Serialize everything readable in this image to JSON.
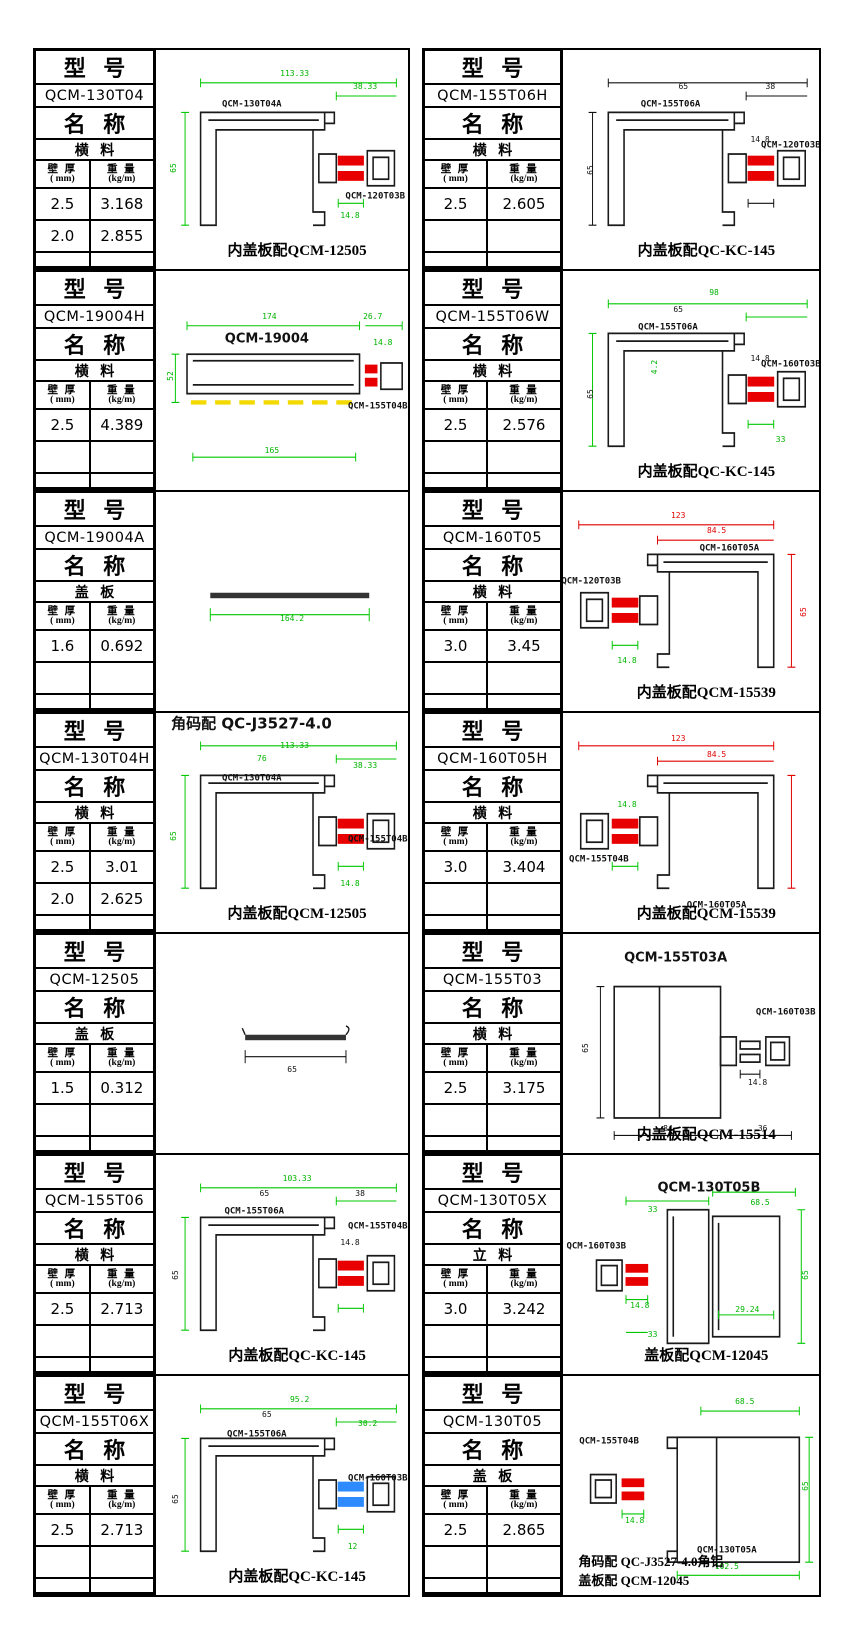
{
  "labels": {
    "model": "型  号",
    "name": "名  称",
    "wall": "壁 厚",
    "wall_unit": "( mm)",
    "weight": "重 量",
    "weight_unit": "(kg/m)"
  },
  "colors": {
    "dim_green": "#00c800",
    "dim_red": "#e00000",
    "connector_red": "#e80000",
    "connector_blue": "#2e8bff",
    "dashed_yellow": "#f2d900"
  },
  "blocks": [
    {
      "col": 0,
      "model": "QCM-130T04",
      "name": "横  料",
      "rows": [
        [
          "2.5",
          "3.168"
        ],
        [
          "2.0",
          "2.855"
        ],
        [
          "",
          ""
        ]
      ],
      "drawing": {
        "variant": "channelRight",
        "conn": "#e80000",
        "dimc": "#00c800",
        "annotations": [
          {
            "t": "113.33",
            "k": "dim",
            "c": "green",
            "x": 55,
            "y": 11
          },
          {
            "t": "38.33",
            "k": "dim",
            "c": "green",
            "x": 83,
            "y": 17
          },
          {
            "t": "QCM-130T04A",
            "k": "label",
            "c": "black",
            "x": 38,
            "y": 25
          },
          {
            "t": "65",
            "k": "dim",
            "c": "green",
            "x": 7,
            "y": 54,
            "rot": true
          },
          {
            "t": "14.8",
            "k": "dim",
            "c": "green",
            "x": 77,
            "y": 76
          },
          {
            "t": "QCM-120T03B",
            "k": "label",
            "c": "black",
            "x": 87,
            "y": 67
          }
        ],
        "caption": "内盖板配QCM-12505",
        "caption2": ""
      }
    },
    {
      "col": 0,
      "model": "QCM-19004H",
      "name": "横  料",
      "rows": [
        [
          "2.5",
          "4.389"
        ],
        [
          "",
          ""
        ],
        [
          "",
          ""
        ]
      ],
      "drawing": {
        "variant": "longbox",
        "conn": "#e80000",
        "dimc": "#00c800",
        "annotations": [
          {
            "t": "174",
            "k": "dim",
            "c": "green",
            "x": 45,
            "y": 21
          },
          {
            "t": "26.7",
            "k": "dim",
            "c": "green",
            "x": 86,
            "y": 21
          },
          {
            "t": "QCM-19004",
            "k": "title",
            "c": "black",
            "x": 44,
            "y": 31
          },
          {
            "t": "52",
            "k": "dim",
            "c": "green",
            "x": 6,
            "y": 48,
            "rot": true
          },
          {
            "t": "14.8",
            "k": "dim",
            "c": "green",
            "x": 90,
            "y": 33
          },
          {
            "t": "QCM-155T04B",
            "k": "label",
            "c": "black",
            "x": 88,
            "y": 62
          },
          {
            "t": "165",
            "k": "dim",
            "c": "green",
            "x": 46,
            "y": 82
          }
        ],
        "caption": "",
        "caption2": ""
      }
    },
    {
      "col": 0,
      "model": "QCM-19004A",
      "name": "盖  板",
      "rows": [
        [
          "1.6",
          "0.692"
        ],
        [
          "",
          ""
        ],
        [
          "",
          ""
        ]
      ],
      "drawing": {
        "variant": "flatbar",
        "conn": "#e80000",
        "dimc": "#00c800",
        "annotations": [
          {
            "t": "164.2",
            "k": "dim",
            "c": "green",
            "x": 54,
            "y": 58
          }
        ],
        "caption": "",
        "caption2": ""
      }
    },
    {
      "col": 0,
      "model": "QCM-130T04H",
      "name": "横  料",
      "rows": [
        [
          "2.5",
          "3.01"
        ],
        [
          "2.0",
          "2.625"
        ],
        [
          "",
          ""
        ]
      ],
      "drawing": {
        "variant": "channelRight",
        "conn": "#e80000",
        "dimc": "#00c800",
        "annotations": [
          {
            "t": "角码配 QC-J3527-4.0",
            "k": "note",
            "c": "black",
            "x": 6,
            "y": 5
          },
          {
            "t": "113.33",
            "k": "dim",
            "c": "green",
            "x": 55,
            "y": 15
          },
          {
            "t": "76",
            "k": "dim",
            "c": "green",
            "x": 42,
            "y": 21
          },
          {
            "t": "38.33",
            "k": "dim",
            "c": "green",
            "x": 83,
            "y": 24
          },
          {
            "t": "QCM-130T04A",
            "k": "label",
            "c": "black",
            "x": 38,
            "y": 30
          },
          {
            "t": "65",
            "k": "dim",
            "c": "green",
            "x": 7,
            "y": 56,
            "rot": true
          },
          {
            "t": "14.8",
            "k": "dim",
            "c": "green",
            "x": 77,
            "y": 78
          },
          {
            "t": "QCM-155T04B",
            "k": "label",
            "c": "black",
            "x": 88,
            "y": 58
          }
        ],
        "caption": "内盖板配QCM-12505",
        "caption2": ""
      }
    },
    {
      "col": 0,
      "model": "QCM-12505",
      "name": "盖  板",
      "rows": [
        [
          "1.5",
          "0.312"
        ],
        [
          "",
          ""
        ],
        [
          "",
          ""
        ]
      ],
      "drawing": {
        "variant": "flatbarShort",
        "conn": "#e80000",
        "dimc": "#111111",
        "annotations": [
          {
            "t": "65",
            "k": "dim",
            "c": "black",
            "x": 54,
            "y": 62
          }
        ],
        "caption": "",
        "caption2": ""
      }
    },
    {
      "col": 0,
      "model": "QCM-155T06",
      "name": "横  料",
      "rows": [
        [
          "2.5",
          "2.713"
        ],
        [
          "",
          ""
        ],
        [
          "",
          ""
        ]
      ],
      "drawing": {
        "variant": "channelRight",
        "conn": "#e80000",
        "dimc": "#00c800",
        "annotations": [
          {
            "t": "103.33",
            "k": "dim",
            "c": "green",
            "x": 56,
            "y": 11
          },
          {
            "t": "65",
            "k": "dim",
            "c": "black",
            "x": 43,
            "y": 18
          },
          {
            "t": "38",
            "k": "dim",
            "c": "black",
            "x": 81,
            "y": 18
          },
          {
            "t": "QCM-155T06A",
            "k": "label",
            "c": "black",
            "x": 39,
            "y": 26
          },
          {
            "t": "65",
            "k": "dim",
            "c": "black",
            "x": 8,
            "y": 55,
            "rot": true
          },
          {
            "t": "14.8",
            "k": "dim",
            "c": "black",
            "x": 77,
            "y": 40
          },
          {
            "t": "QCM-155T04B",
            "k": "label",
            "c": "black",
            "x": 88,
            "y": 33
          }
        ],
        "caption": "内盖板配QC-KC-145",
        "caption2": ""
      }
    },
    {
      "col": 0,
      "model": "QCM-155T06X",
      "name": "横  料",
      "rows": [
        [
          "2.5",
          "2.713"
        ],
        [
          "",
          ""
        ],
        [
          "",
          ""
        ]
      ],
      "drawing": {
        "variant": "channelRight",
        "conn": "#2e8bff",
        "dimc": "#00c800",
        "annotations": [
          {
            "t": "95.2",
            "k": "dim",
            "c": "green",
            "x": 57,
            "y": 11
          },
          {
            "t": "65",
            "k": "dim",
            "c": "black",
            "x": 44,
            "y": 18
          },
          {
            "t": "30.2",
            "k": "dim",
            "c": "green",
            "x": 84,
            "y": 22
          },
          {
            "t": "QCM-155T06A",
            "k": "label",
            "c": "black",
            "x": 40,
            "y": 27
          },
          {
            "t": "65",
            "k": "dim",
            "c": "black",
            "x": 8,
            "y": 56,
            "rot": true
          },
          {
            "t": "QCM-160T03B",
            "k": "label",
            "c": "black",
            "x": 88,
            "y": 47
          },
          {
            "t": "12",
            "k": "dim",
            "c": "green",
            "x": 78,
            "y": 78
          }
        ],
        "caption": "内盖板配QC-KC-145",
        "caption2": ""
      }
    },
    {
      "col": 1,
      "model": "QCM-155T06H",
      "name": "横  料",
      "rows": [
        [
          "2.5",
          "2.605"
        ],
        [
          "",
          ""
        ],
        [
          "",
          ""
        ]
      ],
      "drawing": {
        "variant": "channelRight",
        "conn": "#e80000",
        "dimc": "#111111",
        "annotations": [
          {
            "t": "65",
            "k": "dim",
            "c": "black",
            "x": 47,
            "y": 17
          },
          {
            "t": "38",
            "k": "dim",
            "c": "black",
            "x": 81,
            "y": 17
          },
          {
            "t": "QCM-155T06A",
            "k": "label",
            "c": "black",
            "x": 42,
            "y": 25
          },
          {
            "t": "65",
            "k": "dim",
            "c": "black",
            "x": 11,
            "y": 55,
            "rot": true
          },
          {
            "t": "14.8",
            "k": "dim",
            "c": "black",
            "x": 77,
            "y": 41
          },
          {
            "t": "QCM-120T03B",
            "k": "label",
            "c": "black",
            "x": 89,
            "y": 44
          }
        ],
        "caption": "内盖板配QC-KC-145",
        "caption2": ""
      }
    },
    {
      "col": 1,
      "model": "QCM-155T06W",
      "name": "横  料",
      "rows": [
        [
          "2.5",
          "2.576"
        ],
        [
          "",
          ""
        ],
        [
          "",
          ""
        ]
      ],
      "drawing": {
        "variant": "channelRight",
        "conn": "#e80000",
        "dimc": "#00c800",
        "annotations": [
          {
            "t": "98",
            "k": "dim",
            "c": "green",
            "x": 59,
            "y": 10
          },
          {
            "t": "65",
            "k": "dim",
            "c": "black",
            "x": 45,
            "y": 18
          },
          {
            "t": "QCM-155T06A",
            "k": "label",
            "c": "black",
            "x": 41,
            "y": 26
          },
          {
            "t": "4.2",
            "k": "dim",
            "c": "green",
            "x": 36,
            "y": 44,
            "rot": true
          },
          {
            "t": "65",
            "k": "dim",
            "c": "black",
            "x": 11,
            "y": 56,
            "rot": true
          },
          {
            "t": "14.8",
            "k": "dim",
            "c": "black",
            "x": 77,
            "y": 40
          },
          {
            "t": "QCM-160T03B",
            "k": "label",
            "c": "black",
            "x": 89,
            "y": 43
          },
          {
            "t": "33",
            "k": "dim",
            "c": "green",
            "x": 85,
            "y": 77
          }
        ],
        "caption": "内盖板配QC-KC-145",
        "caption2": ""
      }
    },
    {
      "col": 1,
      "model": "QCM-160T05",
      "name": "横  料",
      "rows": [
        [
          "3.0",
          "3.45"
        ],
        [
          "",
          ""
        ],
        [
          "",
          ""
        ]
      ],
      "drawing": {
        "variant": "channelLeft",
        "conn": "#e80000",
        "dimc": "#e00000",
        "annotations": [
          {
            "t": "123",
            "k": "dim",
            "c": "red",
            "x": 45,
            "y": 11
          },
          {
            "t": "84.5",
            "k": "dim",
            "c": "red",
            "x": 60,
            "y": 18
          },
          {
            "t": "QCM-160T05A",
            "k": "label",
            "c": "black",
            "x": 65,
            "y": 26
          },
          {
            "t": "QCM-120T03B",
            "k": "label",
            "c": "black",
            "x": 11,
            "y": 41
          },
          {
            "t": "65",
            "k": "dim",
            "c": "red",
            "x": 94,
            "y": 55,
            "rot": true
          },
          {
            "t": "14.8",
            "k": "dim",
            "c": "green",
            "x": 25,
            "y": 77
          }
        ],
        "caption": "内盖板配QCM-15539",
        "caption2": ""
      }
    },
    {
      "col": 1,
      "model": "QCM-160T05H",
      "name": "横  料",
      "rows": [
        [
          "3.0",
          "3.404"
        ],
        [
          "",
          ""
        ],
        [
          "",
          ""
        ]
      ],
      "drawing": {
        "variant": "channelLeft",
        "conn": "#e80000",
        "dimc": "#e00000",
        "annotations": [
          {
            "t": "123",
            "k": "dim",
            "c": "red",
            "x": 45,
            "y": 12
          },
          {
            "t": "84.5",
            "k": "dim",
            "c": "red",
            "x": 60,
            "y": 19
          },
          {
            "t": "14.8",
            "k": "dim",
            "c": "green",
            "x": 25,
            "y": 42
          },
          {
            "t": "QCM-155T04B",
            "k": "label",
            "c": "black",
            "x": 14,
            "y": 67
          },
          {
            "t": "QCM-160T05A",
            "k": "label",
            "c": "black",
            "x": 60,
            "y": 88
          }
        ],
        "caption": "内盖板配QCM-15539",
        "caption2": ""
      }
    },
    {
      "col": 1,
      "model": "QCM-155T03",
      "name": "横  料",
      "rows": [
        [
          "2.5",
          "3.175"
        ],
        [
          "",
          ""
        ],
        [
          "",
          ""
        ]
      ],
      "drawing": {
        "variant": "tallbox",
        "conn": "#111111",
        "dimc": "#111111",
        "annotations": [
          {
            "t": "QCM-155T03A",
            "k": "title",
            "c": "black",
            "x": 44,
            "y": 11
          },
          {
            "t": "65",
            "k": "dim",
            "c": "black",
            "x": 9,
            "y": 52,
            "rot": true
          },
          {
            "t": "QCM-160T03B",
            "k": "label",
            "c": "black",
            "x": 87,
            "y": 36
          },
          {
            "t": "14.8",
            "k": "dim",
            "c": "black",
            "x": 76,
            "y": 68
          },
          {
            "t": "84",
            "k": "dim",
            "c": "black",
            "x": 41,
            "y": 89
          },
          {
            "t": "36",
            "k": "dim",
            "c": "black",
            "x": 78,
            "y": 89
          }
        ],
        "caption": "内盖板配QCM-15514",
        "caption2": ""
      }
    },
    {
      "col": 1,
      "model": "QCM-130T05X",
      "name": "立  料",
      "rows": [
        [
          "3.0",
          "3.242"
        ],
        [
          "",
          ""
        ],
        [
          "",
          ""
        ]
      ],
      "drawing": {
        "variant": "mullion",
        "conn": "#e80000",
        "dimc": "#00c800",
        "annotations": [
          {
            "t": "QCM-130T05B",
            "k": "title",
            "c": "black",
            "x": 57,
            "y": 15
          },
          {
            "t": "33",
            "k": "dim",
            "c": "green",
            "x": 35,
            "y": 25
          },
          {
            "t": "68.5",
            "k": "dim",
            "c": "green",
            "x": 77,
            "y": 22
          },
          {
            "t": "QCM-160T03B",
            "k": "label",
            "c": "black",
            "x": 13,
            "y": 42
          },
          {
            "t": "14.8",
            "k": "dim",
            "c": "green",
            "x": 30,
            "y": 69
          },
          {
            "t": "29.24",
            "k": "dim",
            "c": "green",
            "x": 72,
            "y": 71
          },
          {
            "t": "65",
            "k": "dim",
            "c": "green",
            "x": 95,
            "y": 55,
            "rot": true
          },
          {
            "t": "33",
            "k": "dim",
            "c": "green",
            "x": 35,
            "y": 82
          }
        ],
        "caption": "盖板配QCM-12045",
        "caption2": ""
      }
    },
    {
      "col": 1,
      "model": "QCM-130T05",
      "name": "盖  板",
      "rows": [
        [
          "2.5",
          "2.865"
        ],
        [
          "",
          ""
        ],
        [
          "",
          ""
        ]
      ],
      "drawing": {
        "variant": "hframe",
        "conn": "#e80000",
        "dimc": "#00c800",
        "annotations": [
          {
            "t": "68.5",
            "k": "dim",
            "c": "green",
            "x": 71,
            "y": 12
          },
          {
            "t": "QCM-155T04B",
            "k": "label",
            "c": "black",
            "x": 18,
            "y": 30
          },
          {
            "t": "14.8",
            "k": "dim",
            "c": "green",
            "x": 28,
            "y": 66
          },
          {
            "t": "65",
            "k": "dim",
            "c": "green",
            "x": 95,
            "y": 50,
            "rot": true
          },
          {
            "t": "QCM-130T05A",
            "k": "label",
            "c": "black",
            "x": 64,
            "y": 80
          },
          {
            "t": "102.5",
            "k": "dim",
            "c": "green",
            "x": 64,
            "y": 87
          }
        ],
        "caption": "角码配  QC-J3527-4.0角铝",
        "caption2": "盖板配  QCM-12045"
      }
    }
  ]
}
